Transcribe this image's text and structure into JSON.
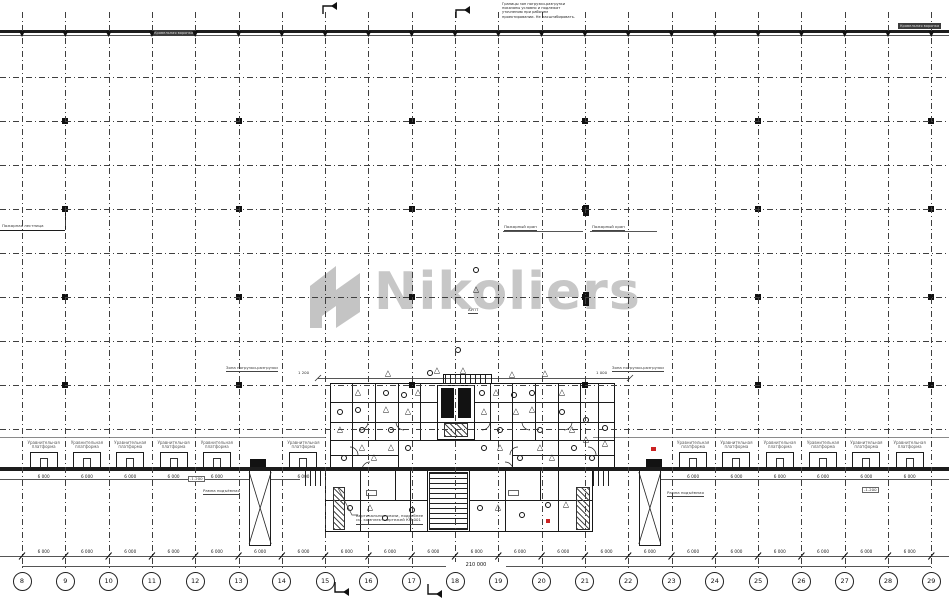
{
  "watermark": {
    "text": "Nikoliers",
    "color": "#c7c7c7"
  },
  "grid": {
    "x0": 22,
    "dx": 43.3,
    "bubbles": [
      "8",
      "9",
      "10",
      "11",
      "12",
      "13",
      "14",
      "15",
      "16",
      "17",
      "18",
      "19",
      "20",
      "21",
      "22",
      "23",
      "24",
      "25",
      "26",
      "27",
      "28",
      "29"
    ],
    "rows_y": [
      77,
      121,
      165,
      209,
      253,
      297,
      341,
      385,
      429
    ],
    "column_row_y": [
      121,
      209,
      297,
      385
    ],
    "column_col_idx": [
      1,
      5,
      9,
      13,
      17,
      21
    ]
  },
  "dims": {
    "bay": "6 000",
    "total": "210 000",
    "sub_bay": "6 000",
    "level_box": "-1.200"
  },
  "docks": {
    "label_line1": "Уравнительная",
    "label_line2": "платформа",
    "bays_left": [
      0,
      1,
      2,
      3,
      4,
      6
    ],
    "bays_right": [
      15,
      16,
      17,
      18,
      19,
      20
    ],
    "ramp_bays": [
      5,
      14
    ]
  },
  "labels": {
    "roof_drain_left": "Кровельная воронка",
    "roof_drain_right": "Кровельная воронка",
    "left_edge": "Пожарная лестница",
    "fire_left": "Пожарный кран",
    "fire_right": "Пожарный кран",
    "zone_left": "Зона погрузки-разгрузки",
    "zone_left_dim": "1 200",
    "zone_right": "Зона погрузки-разгрузки",
    "zone_right_dim": "1 000",
    "ramp_left": "Рампа подъёмная",
    "ramp_right": "Рампа подъёмная",
    "aupt": "АУПТ",
    "bracing_1": "Вертикальные связи, подробнее",
    "bracing_2": "см. комплект чертежей КМ-001",
    "top_note": [
      "Границы зон погрузки-разгрузки",
      "показаны условно и подлежат",
      "уточнению при рабочем",
      "проектировании. Не масштабировать."
    ]
  },
  "geometry": {
    "top_wall_y": 30,
    "bottom_wall_y": 467,
    "canopy_y": 437,
    "dim_line_y": 556,
    "total_line_y": 566,
    "sub_dim_y": 479,
    "walls": [
      [
        330,
        383,
        285,
        87,
        "w15"
      ],
      [
        443,
        374,
        49,
        10,
        "w15"
      ],
      [
        445,
        375,
        45,
        8,
        "stH"
      ],
      [
        325,
        470,
        268,
        62,
        "w15"
      ],
      [
        427,
        470,
        43,
        62,
        "w15"
      ],
      [
        429,
        472,
        39,
        58,
        "stV"
      ],
      [
        443,
        494,
        11,
        22,
        "fill"
      ],
      [
        437,
        385,
        38,
        55,
        "w15"
      ],
      [
        441,
        388,
        13,
        30,
        "fill"
      ],
      [
        458,
        388,
        13,
        30,
        "fill"
      ],
      [
        444,
        423,
        24,
        14,
        "hatch"
      ],
      [
        305,
        470,
        20,
        16,
        "stH"
      ],
      [
        593,
        470,
        20,
        16,
        "stH"
      ],
      [
        333,
        487,
        12,
        43,
        "hatch"
      ],
      [
        576,
        487,
        14,
        43,
        "hatch"
      ],
      [
        583,
        205,
        6,
        11,
        "fill"
      ],
      [
        583,
        292,
        6,
        14,
        "fill"
      ],
      [
        646,
        459,
        16,
        8,
        "fill"
      ],
      [
        250,
        459,
        16,
        8,
        "fill"
      ],
      [
        366,
        490,
        11,
        6,
        "box"
      ],
      [
        436,
        498,
        13,
        7,
        "box"
      ],
      [
        508,
        490,
        11,
        6,
        "box"
      ]
    ],
    "vlines": [
      [
        352,
        383,
        470
      ],
      [
        375,
        383,
        440
      ],
      [
        398,
        383,
        470
      ],
      [
        420,
        383,
        440
      ],
      [
        490,
        383,
        440
      ],
      [
        512,
        383,
        470
      ],
      [
        535,
        383,
        440
      ],
      [
        558,
        383,
        470
      ],
      [
        580,
        383,
        440
      ],
      [
        598,
        383,
        470
      ],
      [
        360,
        470,
        532
      ],
      [
        410,
        470,
        532
      ],
      [
        395,
        470,
        500
      ],
      [
        505,
        470,
        532
      ],
      [
        558,
        470,
        532
      ],
      [
        540,
        470,
        500
      ],
      [
        65,
        213,
        230
      ]
    ],
    "hlines": [
      [
        402,
        330,
        437,
        "solid"
      ],
      [
        402,
        475,
        615,
        "solid"
      ],
      [
        422,
        330,
        615,
        "solid"
      ],
      [
        440,
        330,
        615,
        "solid"
      ],
      [
        455,
        330,
        398,
        "solid"
      ],
      [
        455,
        512,
        615,
        "solid"
      ],
      [
        500,
        325,
        427,
        "solid"
      ],
      [
        500,
        470,
        593,
        "solid"
      ],
      [
        230,
        0,
        65,
        "solid"
      ],
      [
        231,
        503,
        583,
        "thin"
      ],
      [
        231,
        590,
        657,
        "thin"
      ],
      [
        378,
        318,
        630,
        "thin"
      ],
      [
        437,
        0,
        325,
        "thin2"
      ],
      [
        437,
        593,
        949,
        "thin2"
      ],
      [
        479,
        0,
        300,
        "thin"
      ],
      [
        479,
        655,
        949,
        "thin"
      ]
    ],
    "fixtures": [
      [
        476,
        270,
        "c"
      ],
      [
        476,
        290,
        "t"
      ],
      [
        458,
        350,
        "c"
      ],
      [
        437,
        371,
        "t"
      ],
      [
        388,
        374,
        "t"
      ],
      [
        430,
        373,
        "c"
      ],
      [
        463,
        371,
        "t"
      ],
      [
        512,
        375,
        "t"
      ],
      [
        545,
        374,
        "t"
      ],
      [
        340,
        412,
        "c"
      ],
      [
        340,
        430,
        "t"
      ],
      [
        344,
        458,
        "c"
      ],
      [
        358,
        393,
        "t"
      ],
      [
        358,
        410,
        "c"
      ],
      [
        362,
        430,
        "c"
      ],
      [
        362,
        448,
        "t"
      ],
      [
        374,
        458,
        "t"
      ],
      [
        386,
        393,
        "c"
      ],
      [
        386,
        410,
        "t"
      ],
      [
        391,
        430,
        "c"
      ],
      [
        391,
        448,
        "t"
      ],
      [
        404,
        395,
        "c"
      ],
      [
        408,
        412,
        "t"
      ],
      [
        408,
        448,
        "c"
      ],
      [
        418,
        393,
        "t"
      ],
      [
        482,
        393,
        "c"
      ],
      [
        484,
        412,
        "t"
      ],
      [
        484,
        448,
        "c"
      ],
      [
        496,
        393,
        "t"
      ],
      [
        500,
        430,
        "c"
      ],
      [
        500,
        448,
        "t"
      ],
      [
        514,
        395,
        "c"
      ],
      [
        516,
        412,
        "t"
      ],
      [
        520,
        458,
        "c"
      ],
      [
        532,
        393,
        "c"
      ],
      [
        532,
        410,
        "t"
      ],
      [
        540,
        430,
        "c"
      ],
      [
        540,
        448,
        "t"
      ],
      [
        552,
        458,
        "t"
      ],
      [
        562,
        393,
        "t"
      ],
      [
        562,
        412,
        "c"
      ],
      [
        572,
        430,
        "t"
      ],
      [
        574,
        448,
        "c"
      ],
      [
        586,
        420,
        "c"
      ],
      [
        586,
        440,
        "t"
      ],
      [
        592,
        458,
        "c"
      ],
      [
        605,
        428,
        "c"
      ],
      [
        605,
        444,
        "t"
      ],
      [
        350,
        508,
        "c"
      ],
      [
        370,
        508,
        "t"
      ],
      [
        385,
        518,
        "c"
      ],
      [
        412,
        510,
        "c"
      ],
      [
        480,
        508,
        "c"
      ],
      [
        498,
        508,
        "t"
      ],
      [
        522,
        515,
        "c"
      ],
      [
        548,
        505,
        "c"
      ],
      [
        566,
        505,
        "t"
      ]
    ],
    "arcs": [
      [
        360,
        422,
        "se"
      ],
      [
        404,
        422,
        "sw"
      ],
      [
        482,
        422,
        "se"
      ],
      [
        530,
        422,
        "sw"
      ],
      [
        564,
        422,
        "se"
      ],
      [
        350,
        455,
        "ne"
      ],
      [
        518,
        455,
        "nw"
      ],
      [
        588,
        455,
        "ne"
      ],
      [
        370,
        470,
        "nw"
      ],
      [
        505,
        470,
        "ne"
      ]
    ],
    "red": [
      [
        651,
        447,
        5,
        4
      ],
      [
        546,
        519,
        4,
        4
      ]
    ],
    "flags": [
      [
        323,
        2,
        "top"
      ],
      [
        456,
        6,
        "top"
      ],
      [
        335,
        582,
        "bottom"
      ],
      [
        428,
        584,
        "bottom"
      ]
    ],
    "leader": [
      [
        338,
        488
      ],
      [
        352,
        515
      ],
      [
        358,
        515
      ]
    ]
  }
}
